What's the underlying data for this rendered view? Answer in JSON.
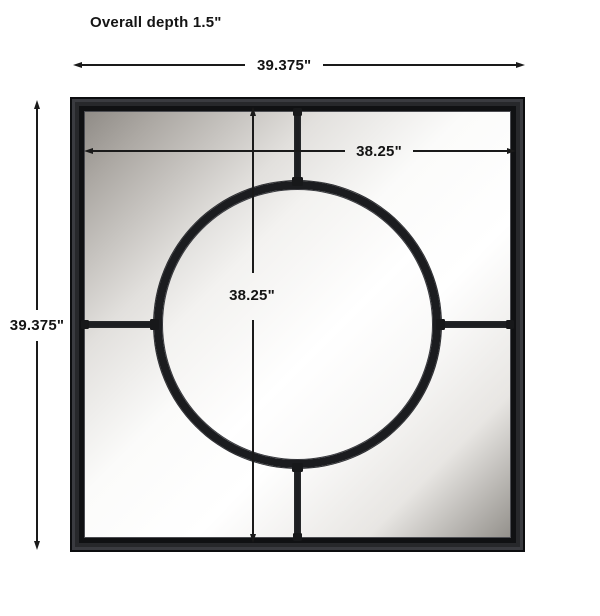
{
  "diagram": {
    "overall_depth_label": "Overall depth 1.5\"",
    "overall_width": "39.375\"",
    "overall_height": "39.375\"",
    "inner_width": "38.25\"",
    "inner_height": "38.25\""
  },
  "colors": {
    "frame_black": "#202124",
    "dimension_line": "#1a1a1a",
    "mirror_gray": "#93908b",
    "mirror_white": "#ffffff",
    "background": "#ffffff"
  }
}
